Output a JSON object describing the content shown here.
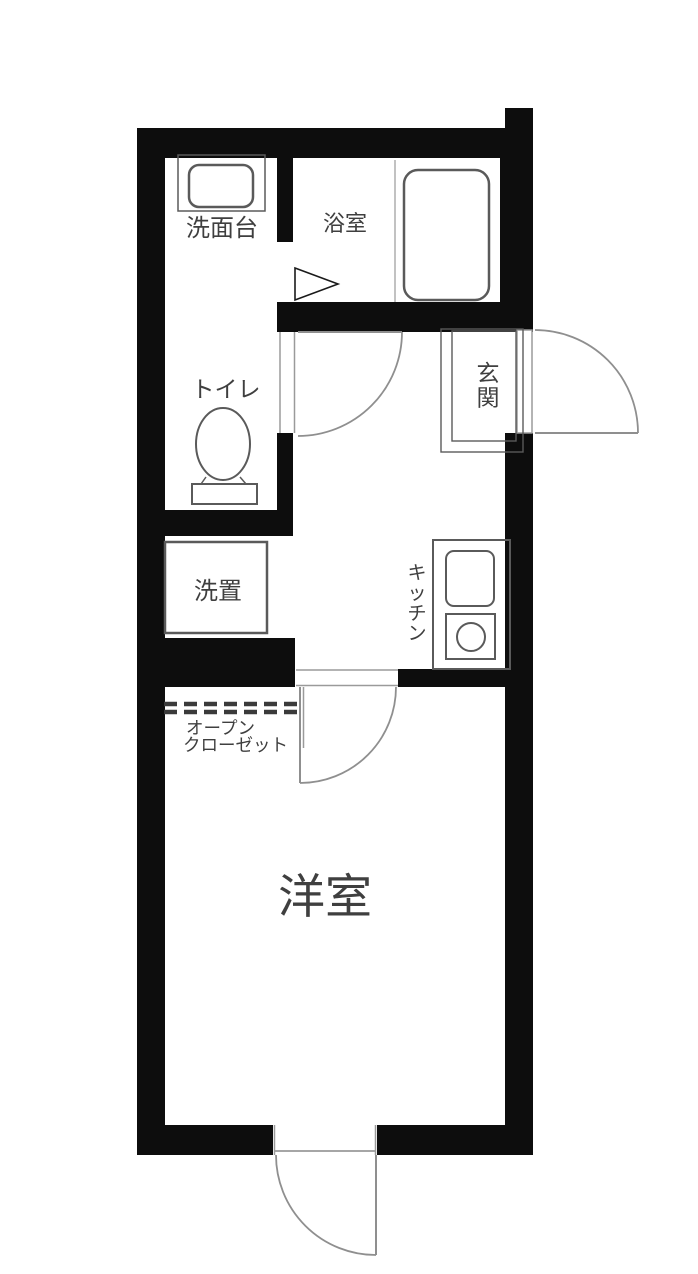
{
  "title": "1K apartment floor plan",
  "colors": {
    "background": "#ffffff",
    "wall": "#0d0d0d",
    "outline": "#5a5a5a",
    "door_line": "#8f8f8f",
    "frame_line": "#9a9a9a",
    "dash": "#3a3a3a",
    "label": "#3f3f3f"
  },
  "rooms": {
    "washbasin": {
      "label": "洗面台"
    },
    "bathroom": {
      "label": "浴室"
    },
    "toilet": {
      "label": "トイレ"
    },
    "entrance": {
      "label": "玄関"
    },
    "laundry": {
      "label": "洗置"
    },
    "kitchen": {
      "label": "キッチン"
    },
    "closet": {
      "label_line1": "オープン",
      "label_line2": "クローゼット"
    },
    "western_room": {
      "label": "洋室"
    }
  }
}
